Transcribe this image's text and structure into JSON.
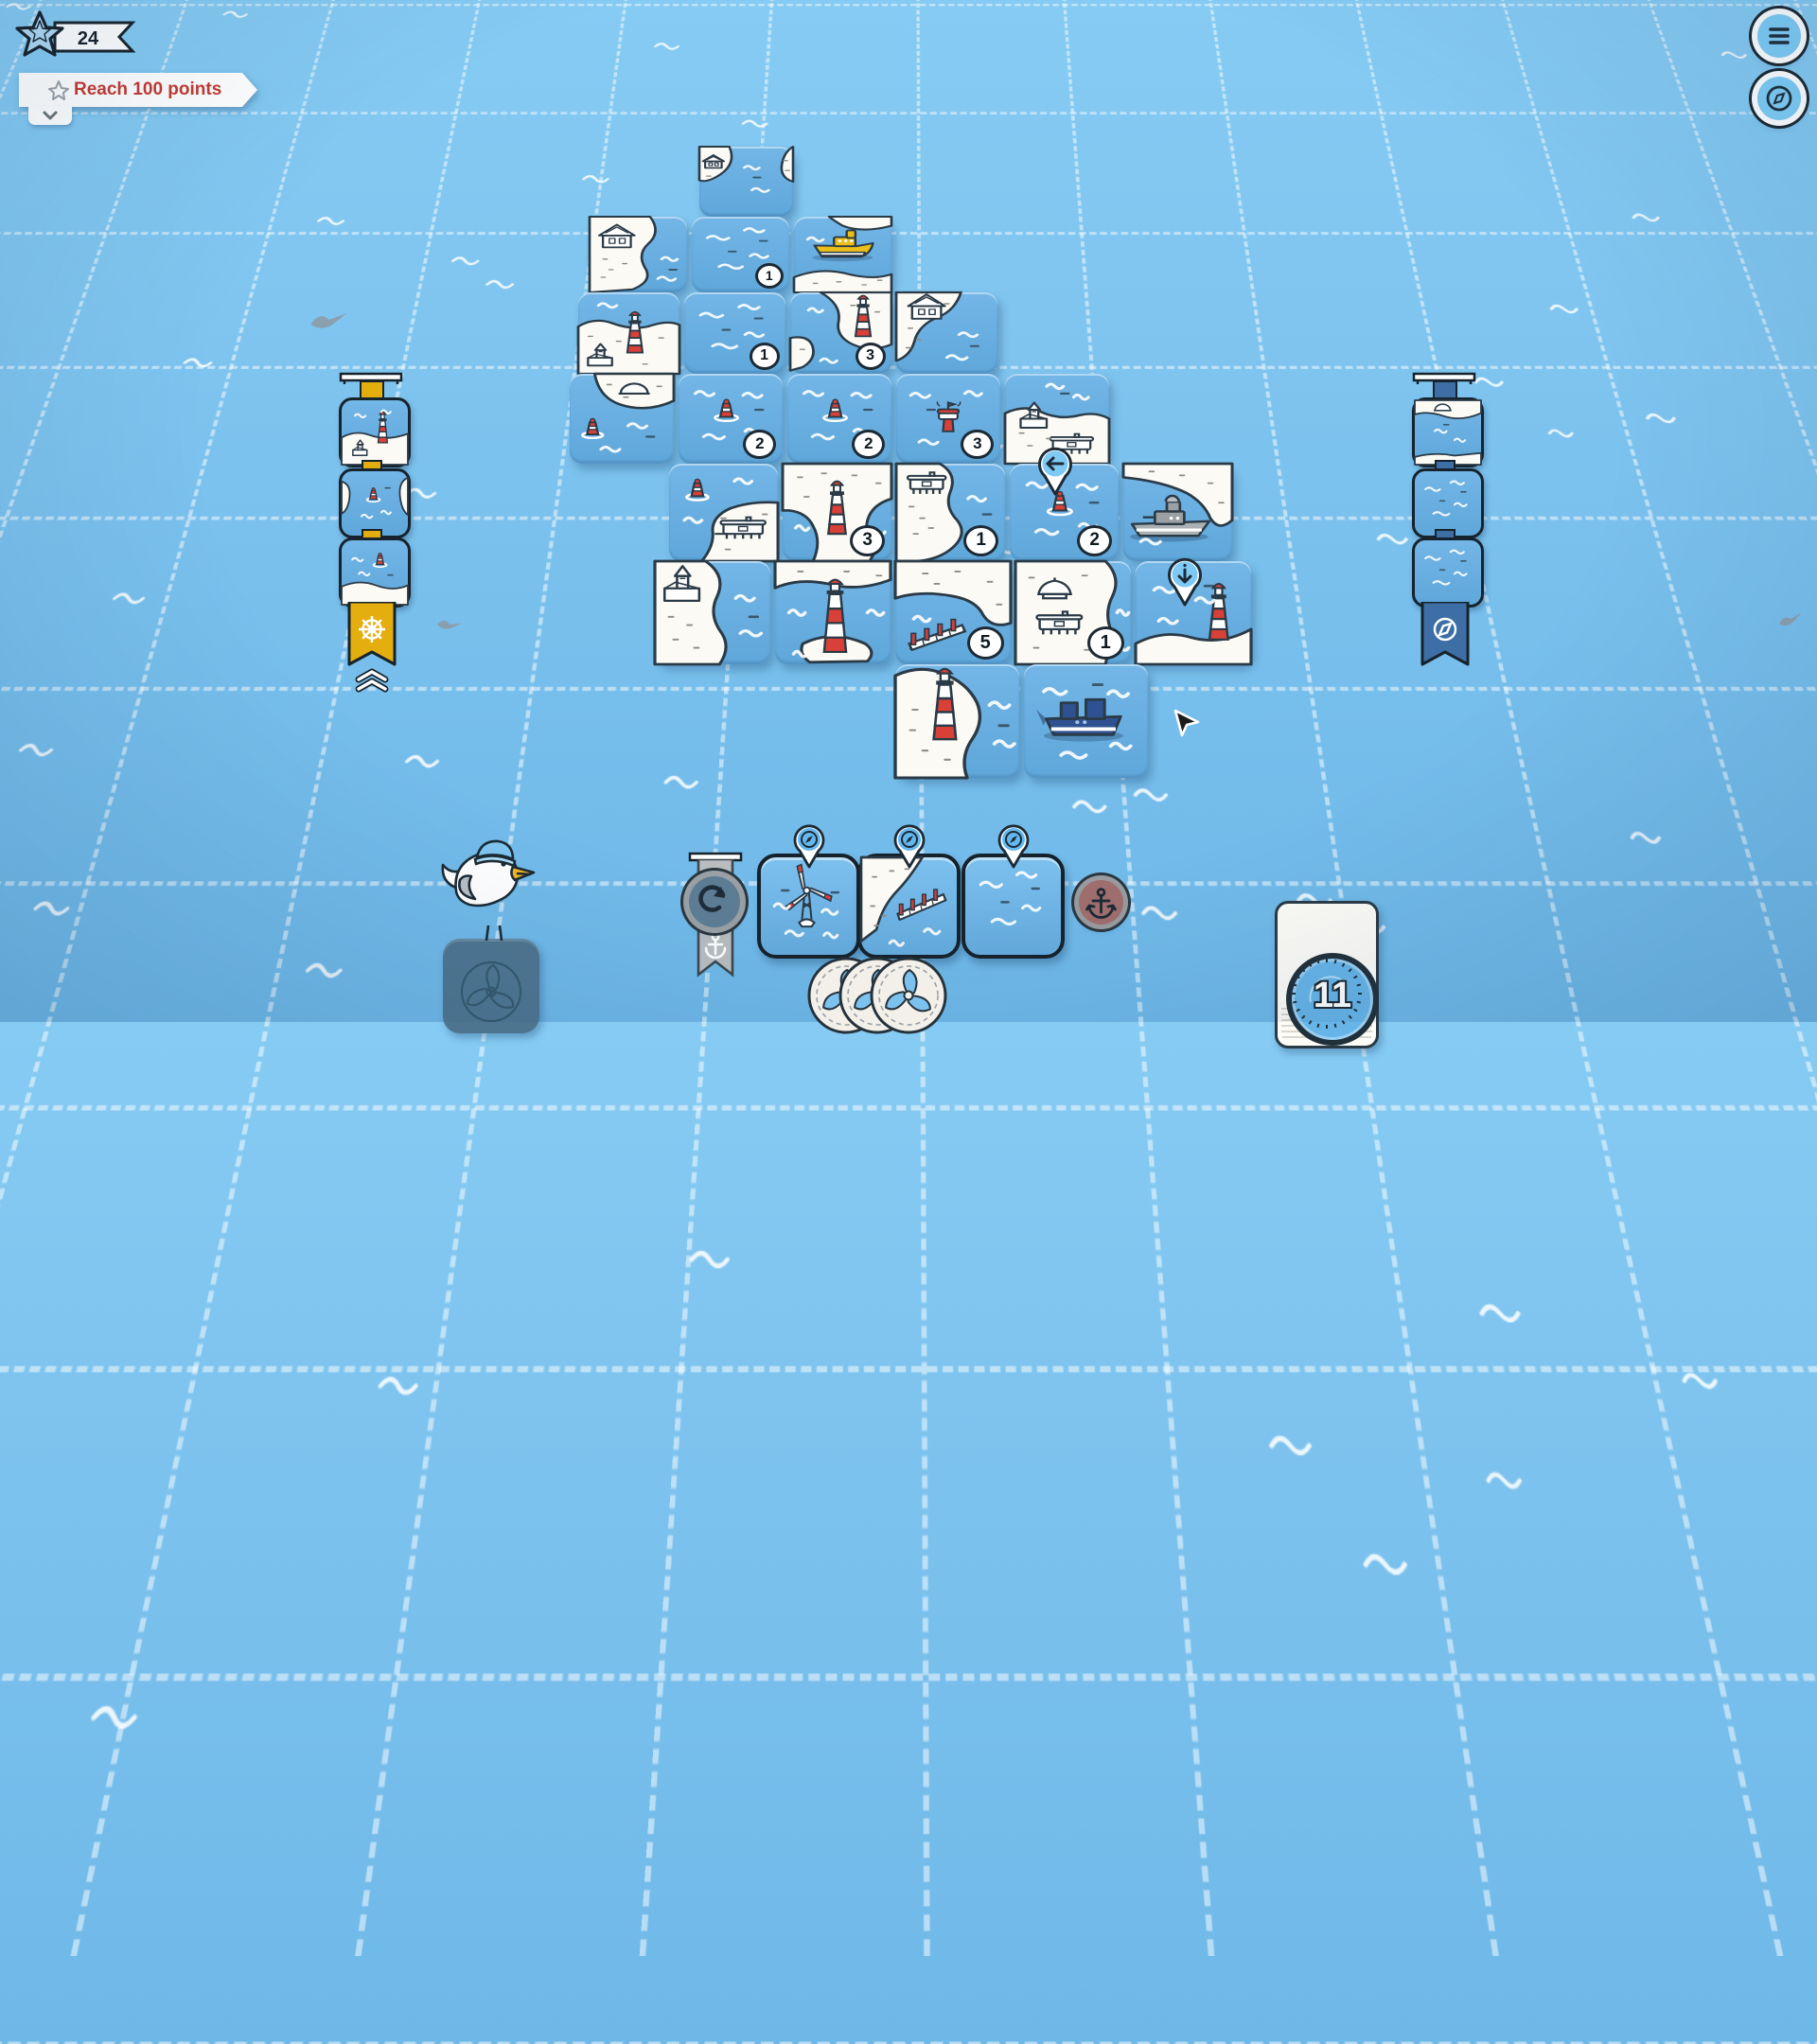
{
  "hud": {
    "score": "24",
    "score_icon": "star-badge",
    "quest": {
      "icon": "star-outline",
      "label": "Reach 100 points"
    },
    "menu_icon": "hamburger-menu",
    "compass_icon": "compass-rose",
    "deck_count": "11"
  },
  "board": {
    "tiles": [
      {
        "col": 2,
        "row": 0,
        "type": "water_shore_sides_house"
      },
      {
        "col": 1,
        "row": 1,
        "type": "island_house_L"
      },
      {
        "col": 2,
        "row": 1,
        "type": "water",
        "num": "1"
      },
      {
        "col": 3,
        "row": 1,
        "type": "boat_yellow"
      },
      {
        "col": 1,
        "row": 2,
        "type": "island_lh_church"
      },
      {
        "col": 2,
        "row": 2,
        "type": "water",
        "num": "1"
      },
      {
        "col": 3,
        "row": 2,
        "type": "island_channel_lh",
        "num": "3"
      },
      {
        "col": 4,
        "row": 2,
        "type": "island_house_TL"
      },
      {
        "col": 1,
        "row": 3,
        "type": "island_dome_buoy"
      },
      {
        "col": 2,
        "row": 3,
        "type": "water_buoy",
        "num": "2"
      },
      {
        "col": 3,
        "row": 3,
        "type": "water_buoy",
        "num": "2"
      },
      {
        "col": 4,
        "row": 3,
        "type": "water_tower",
        "num": "3"
      },
      {
        "col": 5,
        "row": 3,
        "type": "island_harbor"
      },
      {
        "col": 2,
        "row": 4,
        "type": "water_buoy_dock"
      },
      {
        "col": 3,
        "row": 4,
        "type": "island_U_lh",
        "num": "3"
      },
      {
        "col": 4,
        "row": 4,
        "type": "island_dock_L",
        "num": "1"
      },
      {
        "col": 5,
        "row": 4,
        "type": "water_buoy",
        "num": "2",
        "pin": {
          "dir": "left",
          "px": 0.42,
          "py": 0.14
        }
      },
      {
        "col": 6,
        "row": 4,
        "type": "ship_gray"
      },
      {
        "col": 2,
        "row": 5,
        "type": "island_church"
      },
      {
        "col": 3,
        "row": 5,
        "type": "island_lh_big"
      },
      {
        "col": 4,
        "row": 5,
        "type": "island_bridge",
        "num": "5"
      },
      {
        "col": 5,
        "row": 5,
        "type": "island_twodocks",
        "num": "1"
      },
      {
        "col": 6,
        "row": 5,
        "type": "water_lh_pin",
        "pin": {
          "dir": "down",
          "px": 0.43,
          "py": 0.26
        }
      }
    ],
    "bottom_tiles": [
      {
        "col": 4,
        "row": 6,
        "type": "island_lh_xl"
      },
      {
        "col": 5,
        "row": 6,
        "type": "ship_blue"
      }
    ]
  },
  "left_quest_stack": {
    "strap_color": "#e3ae0e",
    "ribbon_icon": "ship-wheel",
    "footer_icon": "double-chevron-up",
    "tiles": [
      "stack_lh_church",
      "stack_buoy_sides",
      "stack_buoy_shore"
    ]
  },
  "right_quest_stack": {
    "strap_color": "#3d6fa6",
    "ribbon_icon": "compass",
    "tiles": [
      "stack_dome_top",
      "water",
      "stack_turbine"
    ]
  },
  "hand": {
    "cards": [
      {
        "type": "water_turbine",
        "badge": "compass"
      },
      {
        "type": "island_bridge_card",
        "badge": "compass"
      },
      {
        "type": "water",
        "badge": "compass"
      }
    ]
  },
  "undo": {
    "icon": "undo-arrow",
    "ribbon_icon": "anchor"
  },
  "anchor_button": {
    "icon": "anchor"
  },
  "coins": {
    "count": 3,
    "icon": "propeller"
  },
  "mascot": {
    "type": "seagull-with-beanie",
    "base_icon": "propeller"
  },
  "cursor": {
    "visible": true
  },
  "colors": {
    "background": "#7cc2ee",
    "tile_water": "#66ace0",
    "island": "#fcfaf4",
    "accent_red": "#d84038",
    "quest_text_red": "#c43a31",
    "quest_yellow": "#e3ae0e",
    "ribbon_blue": "#3d6fa6",
    "mascot_card_slate": "#4e7590",
    "anchor_btn_rose": "#a06e6e"
  }
}
